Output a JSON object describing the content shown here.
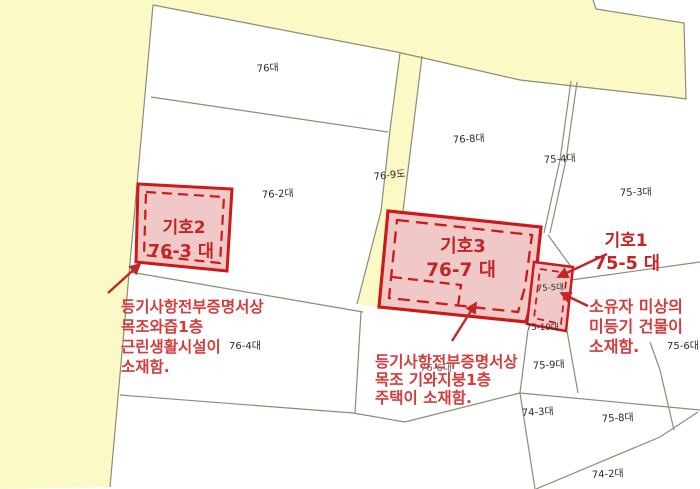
{
  "colors": {
    "road_yellow": "#fbf9c6",
    "parcel_line": "#8c8c78",
    "highlight_fill": "#f0c8c8",
    "highlight_border": "#cc1a1a",
    "annotation_red": "#d43c3c",
    "label_black": "#2b2b2b"
  },
  "labels": {
    "p76": "76대",
    "p76_2": "76-2대",
    "p76_9": "76-9도",
    "p76_8": "76-8대",
    "p75_4": "75-4대",
    "p75_3": "75-3대",
    "p75_5_small": "75-5대",
    "p75_10": "75-10대",
    "p76_4": "76-4대",
    "p76_6": "76-6대",
    "p75_9": "75-9대",
    "p74_3": "74-3대",
    "p75_8": "75-8대",
    "p74_2": "74-2대",
    "p75_6": "75-6대"
  },
  "symbols": {
    "h1": {
      "name": "기호1",
      "lot": "75-5 대"
    },
    "h2": {
      "name": "기호2",
      "lot": "76-3 대"
    },
    "h3": {
      "name": "기호3",
      "lot": "76-7 대"
    }
  },
  "notes": {
    "left": [
      "등기사항전부증명서상",
      "목조와즙1층",
      "근린생활시설이",
      "소재함."
    ],
    "center": [
      "등기사항전부증명서상",
      "목조 기와지붕1층",
      "주택이 소재함."
    ],
    "right": [
      "소유자 미상의",
      "미등기 건물이",
      "소재함."
    ]
  }
}
